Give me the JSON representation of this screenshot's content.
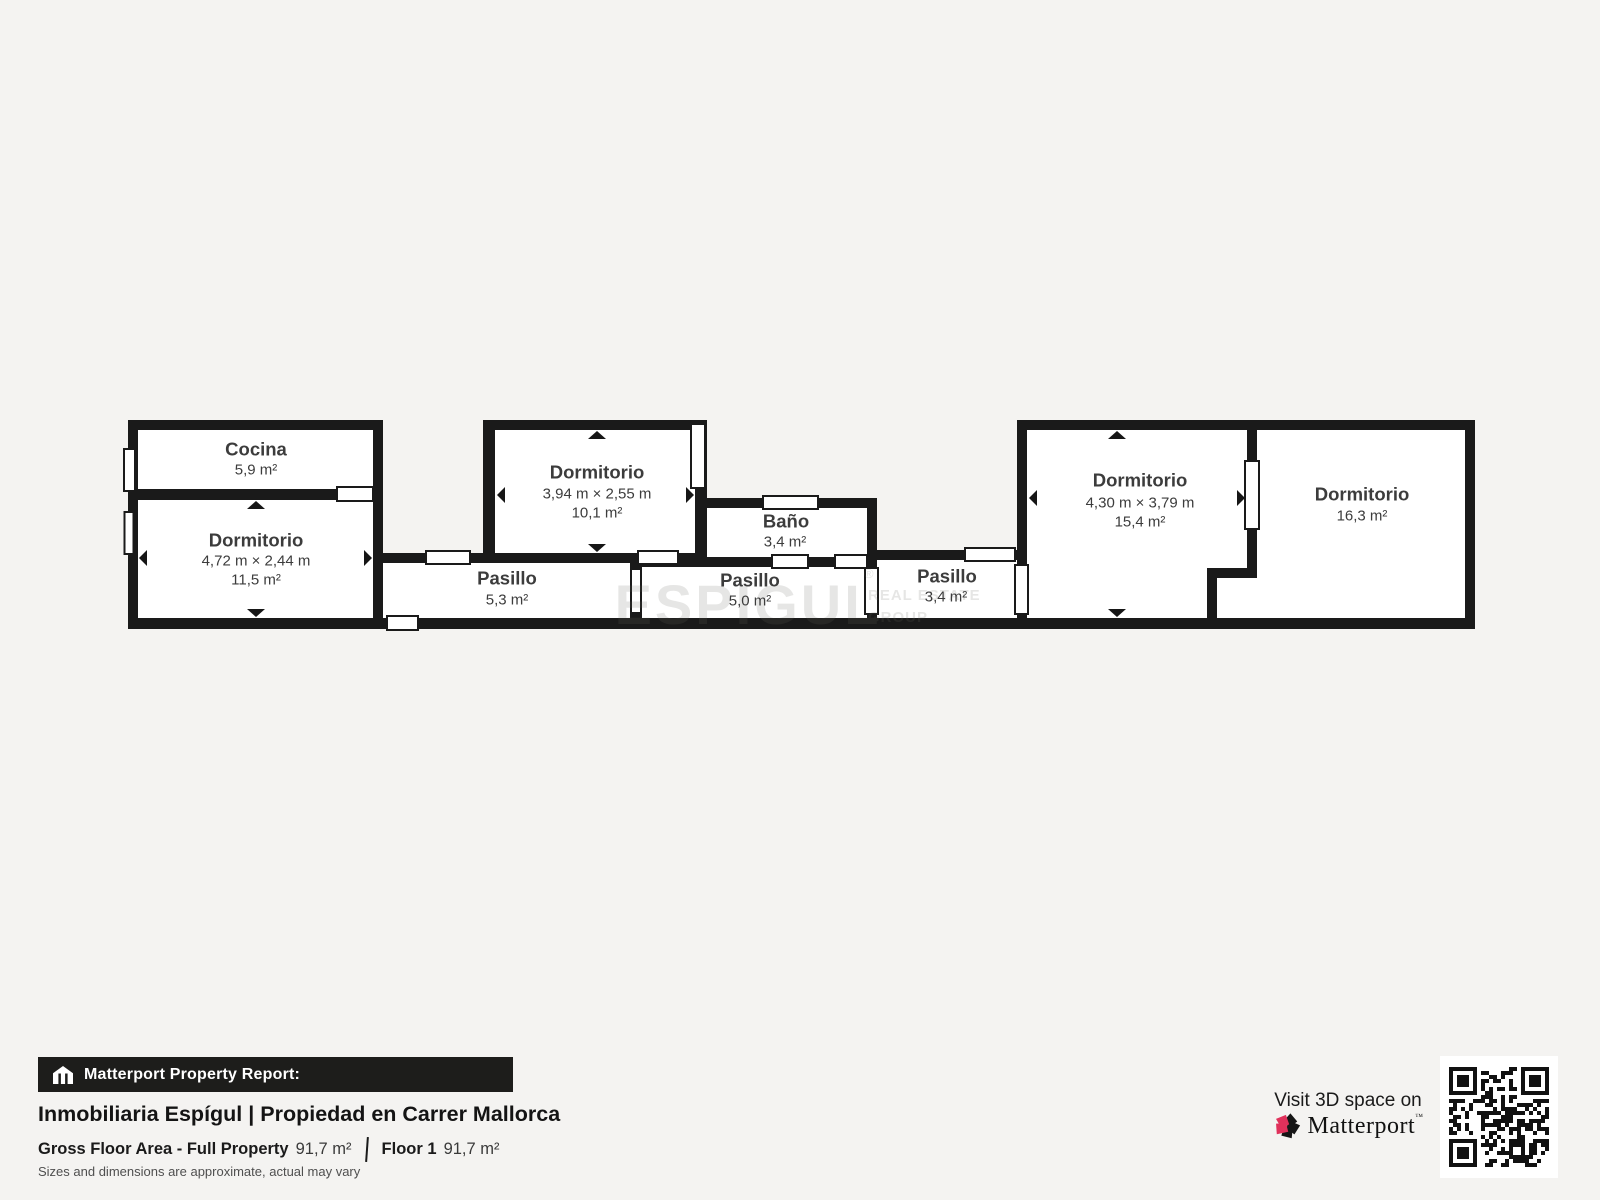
{
  "watermark": {
    "brand": "ESPIGUL",
    "reg": "®",
    "sub1": "REAL ESTATE",
    "sub2": "GROUP"
  },
  "rooms": {
    "cocina": {
      "name": "Cocina",
      "area": "5,9 m²"
    },
    "dorm1": {
      "name": "Dormitorio",
      "dims": "4,72 m × 2,44 m",
      "area": "11,5 m²"
    },
    "pasillo1": {
      "name": "Pasillo",
      "area": "5,3 m²"
    },
    "dorm2": {
      "name": "Dormitorio",
      "dims": "3,94 m × 2,55 m",
      "area": "10,1 m²"
    },
    "bano": {
      "name": "Baño",
      "area": "3,4 m²"
    },
    "pasillo2": {
      "name": "Pasillo",
      "area": "5,0 m²"
    },
    "pasillo3": {
      "name": "Pasillo",
      "area": "3,4 m²"
    },
    "dorm3": {
      "name": "Dormitorio",
      "dims": "4,30 m × 3,79 m",
      "area": "15,4 m²"
    },
    "dorm4": {
      "name": "Dormitorio",
      "area": "16,3 m²"
    }
  },
  "footer": {
    "banner_label": "Matterport Property Report:",
    "title": "Inmobiliaria Espígul | Propiedad en Carrer Mallorca",
    "gfa_label": "Gross Floor Area - Full Property",
    "gfa_value": "91,7 m²",
    "floor_label": "Floor 1",
    "floor_value": "91,7 m²",
    "disclaimer": "Sizes and dimensions are approximate, actual may vary"
  },
  "cta": {
    "visit_text": "Visit 3D space on",
    "brand": "Matterport",
    "trademark": "™"
  },
  "colors": {
    "background": "#f4f3f1",
    "wall": "#1a1a1a",
    "floor": "#ffffff",
    "room_text": "#3c3c3c",
    "banner_bg": "#1d1d1b",
    "matterport_pink": "#e0315b"
  }
}
